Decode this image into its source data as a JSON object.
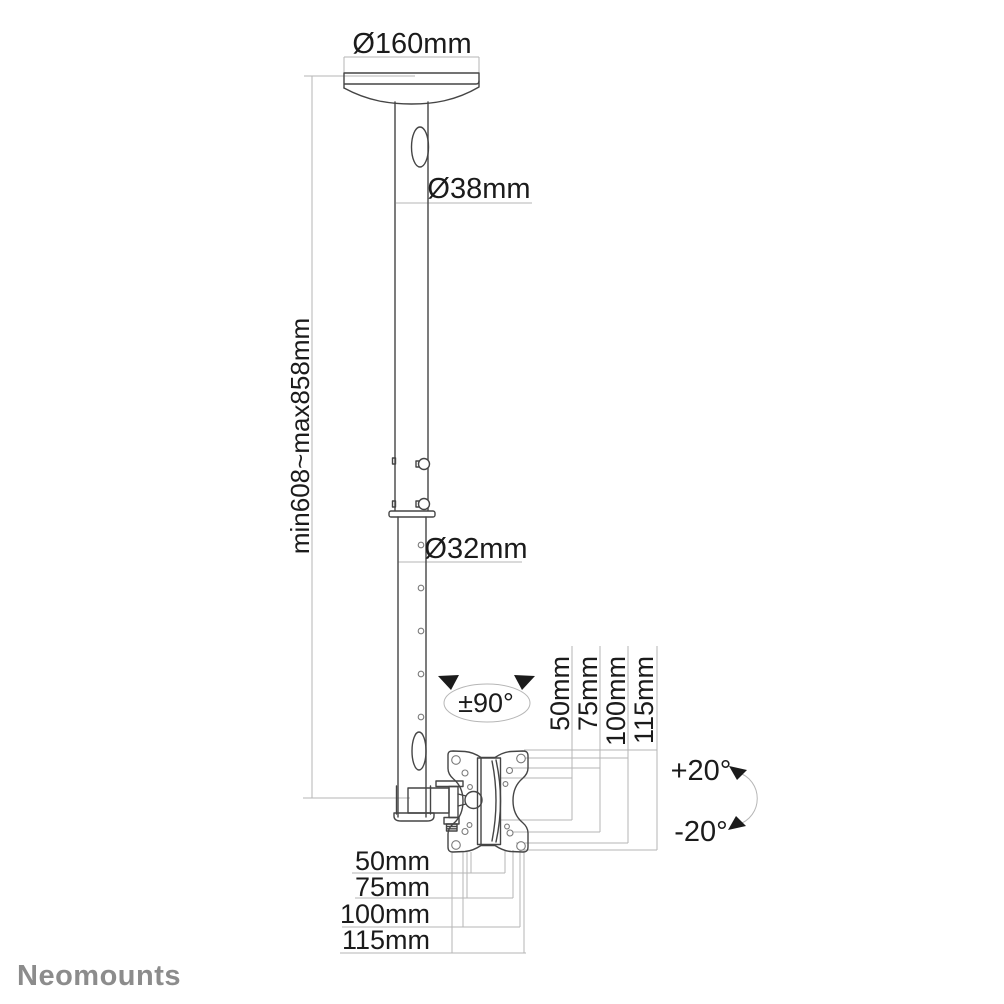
{
  "diagram": {
    "title_context": "ceiling-mount dimension drawing",
    "brand": "Neomounts",
    "labels": {
      "ceiling_plate_diameter": "Ø160mm",
      "upper_pole_diameter": "Ø38mm",
      "height_range": "min608~max858mm",
      "lower_pole_diameter": "Ø32mm",
      "rotation": "±90°",
      "tilt_up": "+20°",
      "tilt_down": "-20°"
    },
    "vesa_vertical_mm": [
      "50mm",
      "75mm",
      "100mm",
      "115mm"
    ],
    "vesa_horizontal_mm": [
      "50mm",
      "75mm",
      "100mm",
      "115mm"
    ],
    "colors": {
      "outline": "#454545",
      "dimension_line": "#b6b6b6",
      "text": "#1b1b1b",
      "logo": "#8c8c8c",
      "background": "#ffffff"
    }
  }
}
